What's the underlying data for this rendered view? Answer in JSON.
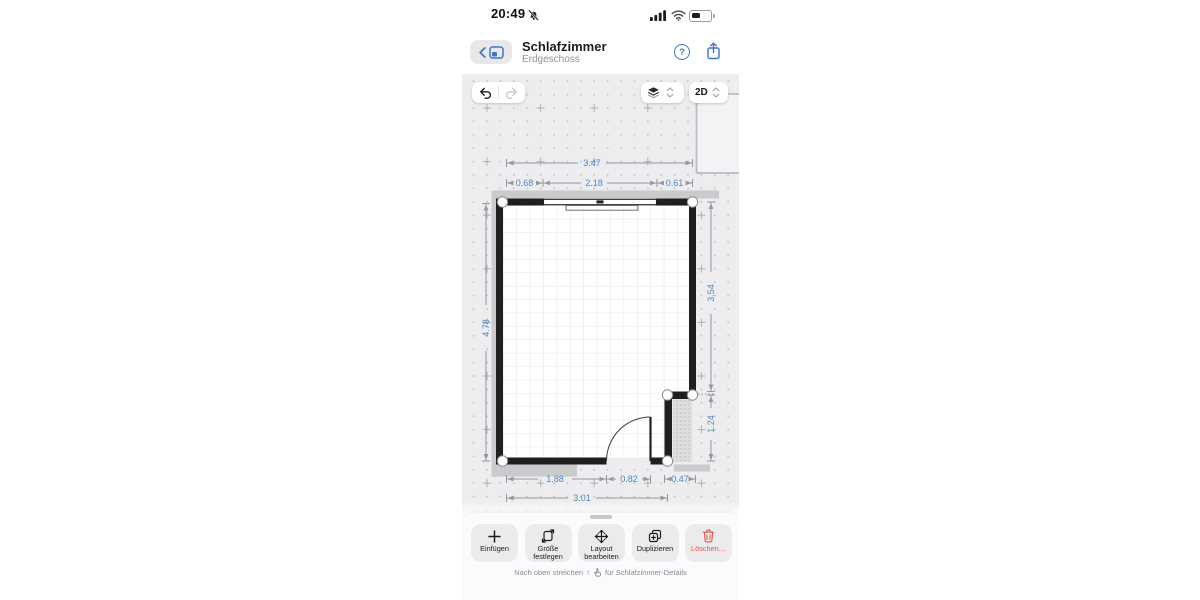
{
  "status_bar": {
    "time": "20:49"
  },
  "header": {
    "title": "Schlafzimmer",
    "subtitle": "Erdgeschoss",
    "help_glyph": "?"
  },
  "canvas_toolbar": {
    "view_mode": "2D"
  },
  "plan": {
    "dims": {
      "top_total": "3.47",
      "top_left": "0.68",
      "top_mid": "2.18",
      "top_right": "0.61",
      "left": "4.78",
      "right_upper": "3.54",
      "right_lower": "1.24",
      "bottom_left": "1.88",
      "bottom_door": "0.82",
      "bottom_right": "0.47",
      "bottom_total": "3.01"
    }
  },
  "bottom_toolbar": {
    "buttons": [
      {
        "label": "Einfügen"
      },
      {
        "label": "Größe festlegen"
      },
      {
        "label": "Layout bearbeiten"
      },
      {
        "label": "Duplizieren"
      },
      {
        "label": "Löschen…"
      }
    ]
  },
  "hint": {
    "prefix": "Nach oben streichen",
    "arrow_glyph": "↑",
    "suffix": "für Schlafzimmer-Details"
  },
  "colors": {
    "accent_blue": "#4178bf",
    "dimension_blue": "#4e86c5",
    "destructive_red": "#e4574c",
    "wall": "#1f1f21",
    "canvas": "#ededef"
  }
}
